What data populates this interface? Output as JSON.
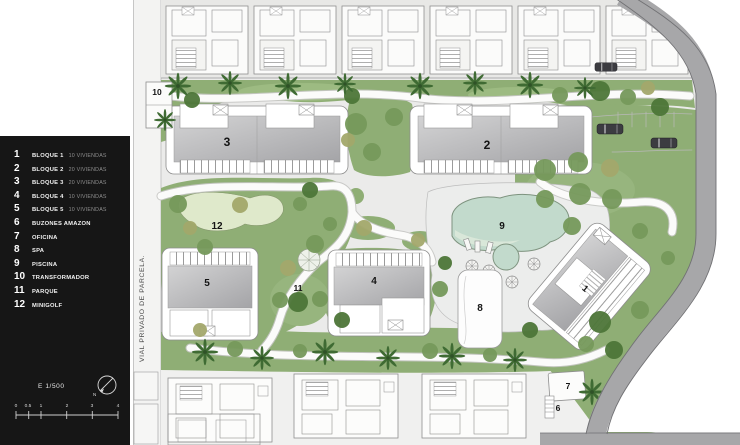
{
  "legend": {
    "items": [
      {
        "num": "1",
        "label": "BLOQUE 1",
        "detail": "10 VIVIENDAS"
      },
      {
        "num": "2",
        "label": "BLOQUE 2",
        "detail": "20 VIVIENDAS"
      },
      {
        "num": "3",
        "label": "BLOQUE 3",
        "detail": "20 VIVIENDAS"
      },
      {
        "num": "4",
        "label": "BLOQUE 4",
        "detail": "10 VIVIENDAS"
      },
      {
        "num": "5",
        "label": "BLOQUE 5",
        "detail": "10 VIVIENDAS"
      },
      {
        "num": "6",
        "label": "BUZONES AMAZON",
        "detail": ""
      },
      {
        "num": "7",
        "label": "OFICINA",
        "detail": ""
      },
      {
        "num": "8",
        "label": "SPA",
        "detail": ""
      },
      {
        "num": "9",
        "label": "PISCINA",
        "detail": ""
      },
      {
        "num": "10",
        "label": "TRANSFORMADOR",
        "detail": ""
      },
      {
        "num": "11",
        "label": "PARQUE",
        "detail": ""
      },
      {
        "num": "12",
        "label": "MINIGOLF",
        "detail": ""
      }
    ],
    "scale_text": "E 1/500",
    "scale_ticks": [
      "0",
      "0.5",
      "1",
      "2",
      "3",
      "4"
    ],
    "north_label": "N"
  },
  "plan": {
    "road_label": "VIAL PRIVADO DE PARCELA.",
    "labels": [
      {
        "text": "10"
      },
      {
        "text": "3"
      },
      {
        "text": "2"
      },
      {
        "text": "12"
      },
      {
        "text": "9"
      },
      {
        "text": "5"
      },
      {
        "text": "4"
      },
      {
        "text": "11"
      },
      {
        "text": "1"
      },
      {
        "text": "8"
      },
      {
        "text": "7"
      },
      {
        "text": "6"
      }
    ]
  },
  "colors": {
    "panel": "#161616",
    "ground": "#ebebea",
    "green": "#8fae75",
    "green_dark": "#4d7638",
    "minigolf": "#dfe9cb",
    "pool": "#c2dacc",
    "road": "#a7a7a9",
    "roof_gray": "#b9b9bb"
  }
}
